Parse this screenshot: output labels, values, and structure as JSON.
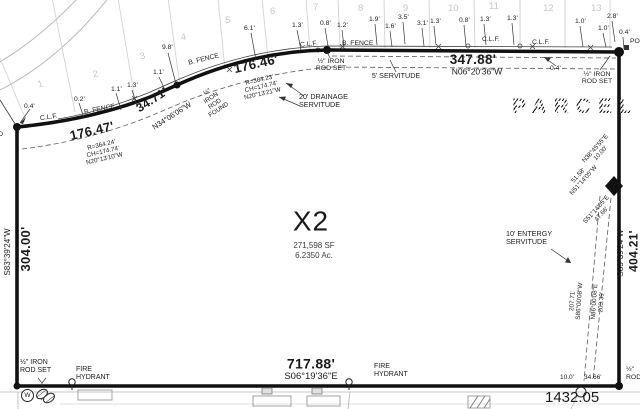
{
  "parcel": {
    "label": "X2",
    "area_sf": "271,598 SF",
    "area_ac": "6.2350 Ac.",
    "adjacent_parcel": "PARCEL X"
  },
  "lots": [
    "1",
    "2",
    "3",
    "4",
    "5",
    "6",
    "7",
    "8",
    "9",
    "10",
    "11",
    "12",
    "13"
  ],
  "dimensions": {
    "left": {
      "bearing": "S83°39'24\"W",
      "distance": "304.00'"
    },
    "right": {
      "bearing": "S83°39'24\"W",
      "distance": "404.21'"
    },
    "bottom": {
      "bearing": "S06°19'36\"E",
      "distance": "717.88'"
    },
    "curve1": {
      "distance": "176.47'",
      "radius": "R=364.24'",
      "chord": "CH=174.74'",
      "chord_bearing": "N20°13'10\"W"
    },
    "segment": {
      "distance": "34.71'",
      "bearing": "N34°06'06\"W"
    },
    "curve2": {
      "distance": "176.46'",
      "radius": "R=364.23'",
      "chord": "CH=174.74'",
      "chord_bearing": "N20°13'21\"W"
    },
    "top": {
      "distance": "347.88'",
      "bearing": "N06°20'36\"W"
    },
    "road": {
      "distance": "1432.05"
    }
  },
  "monuments": {
    "iron_rod_found_edge": [
      "IRON",
      "ROD",
      "FOUND"
    ],
    "iron_rod_found": [
      "½\"",
      "IRON",
      "ROD",
      "FOUND"
    ],
    "iron_rod_set_mid": [
      "½\" IRON",
      "ROD SET"
    ],
    "iron_rod_set_right": [
      "½\" IRON",
      "ROD SET"
    ],
    "iron_rod_set_bottom": [
      "½\" IRON",
      "ROD SET"
    ],
    "iron_rod_edge_right": [
      "½\"",
      "ROD"
    ],
    "post": "POST",
    "water_meter": "W"
  },
  "servitudes": {
    "drainage": [
      "20' DRAINAGE",
      "SERVITUDE"
    ],
    "five_ft": "5' SERVITUDE",
    "entergy": [
      "10' ENTERGY",
      "SERVITUDE"
    ],
    "entergy_line1": [
      "207.71'",
      "S86°00'08\"W"
    ],
    "entergy_line2": [
      "N86°00'08\"E",
      "203.39'"
    ],
    "notch1": [
      "N38°45'55\"E",
      "10.00'"
    ],
    "notch2": [
      "51.58'",
      "N51°14'05\"W"
    ],
    "notch3": [
      "S51°14'05\"E",
      "47.66'"
    ],
    "offset1": "10.0'",
    "offset2": "34.66'"
  },
  "features": {
    "fire_hydrant": [
      "FIRE",
      "HYDRANT"
    ]
  },
  "fences": {
    "clf": "C.L.F.",
    "b_fence": "B. FENCE"
  },
  "ticks": [
    "0.4'",
    "0.2'",
    "1.1'",
    "1.3'",
    "1.1'",
    "9.8'",
    "6.1'",
    "1.3'",
    "0.8'",
    "1.2'",
    "1.9'",
    "1.6'",
    "3.5'",
    "3.1'",
    "1.3'",
    "0.8'",
    "1.3'",
    "1.3'",
    "1.0'",
    "2.8'",
    "1.0'",
    "0.4'",
    "0.4'"
  ]
}
